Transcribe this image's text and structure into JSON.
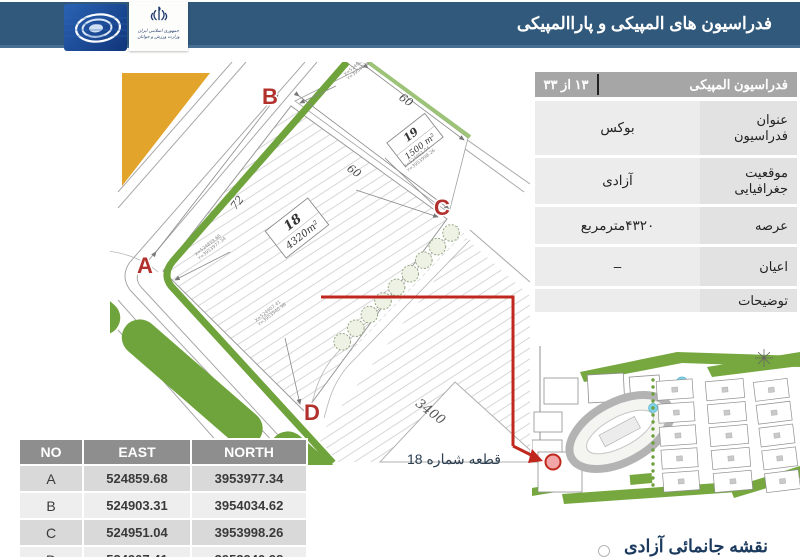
{
  "header": {
    "title": "فدراسیون های المپیکی و پاراالمپیکی",
    "ministry": {
      "line1": "جمهوری اسلامی ایران",
      "line2": "وزارت ورزش و جوانان"
    }
  },
  "info_panel": {
    "title": "فدراسیون المپیکی",
    "page_indicator": "۱۳ از ۳۳",
    "rows": [
      {
        "label": "عنوان فدراسیون",
        "value": "بوکس"
      },
      {
        "label": "موقعیت جغرافیایی",
        "value": "آزادی"
      },
      {
        "label": "عرصه",
        "value": "۴۳۲۰مترمربع"
      },
      {
        "label": "اعیان",
        "value": "–"
      },
      {
        "label": "توضیحات",
        "value": ""
      }
    ]
  },
  "survey": {
    "points": [
      "A",
      "B",
      "C",
      "D"
    ],
    "plot18": {
      "number": "18",
      "area": "4320m²"
    },
    "plot19": {
      "number": "19",
      "area": "1500 m²"
    },
    "dimensions": {
      "ab": "72",
      "bc": "60",
      "plot19_edge": "60",
      "adjacent_plot": "3400"
    },
    "corner_coords": [
      {
        "line1": "X=524859.68",
        "line2": "Y=3953977.34"
      },
      {
        "line1": "X=524903.31",
        "line2": "Y=3954034.62"
      },
      {
        "line1": "X=524951.04",
        "line2": "Y=3953998.26"
      },
      {
        "line1": "X=524907.41",
        "line2": "Y=3953940.98"
      }
    ]
  },
  "coords_table": {
    "headers": [
      "NO",
      "EAST",
      "NORTH"
    ],
    "rows": [
      [
        "A",
        "524859.68",
        "3953977.34"
      ],
      [
        "B",
        "524903.31",
        "3954034.62"
      ],
      [
        "C",
        "524951.04",
        "3953998.26"
      ],
      [
        "D",
        "524907.41",
        "3953940.98"
      ]
    ]
  },
  "callout": {
    "label": "قطعه شماره 18"
  },
  "caption": "نقشه جانمائی آزادی",
  "colors": {
    "header_bar": "#31597B",
    "accent_red": "#C0281E",
    "road_green": "#6FA33C",
    "block_orange": "#E2A42B",
    "table_header_gray": "#8E8E8E"
  }
}
